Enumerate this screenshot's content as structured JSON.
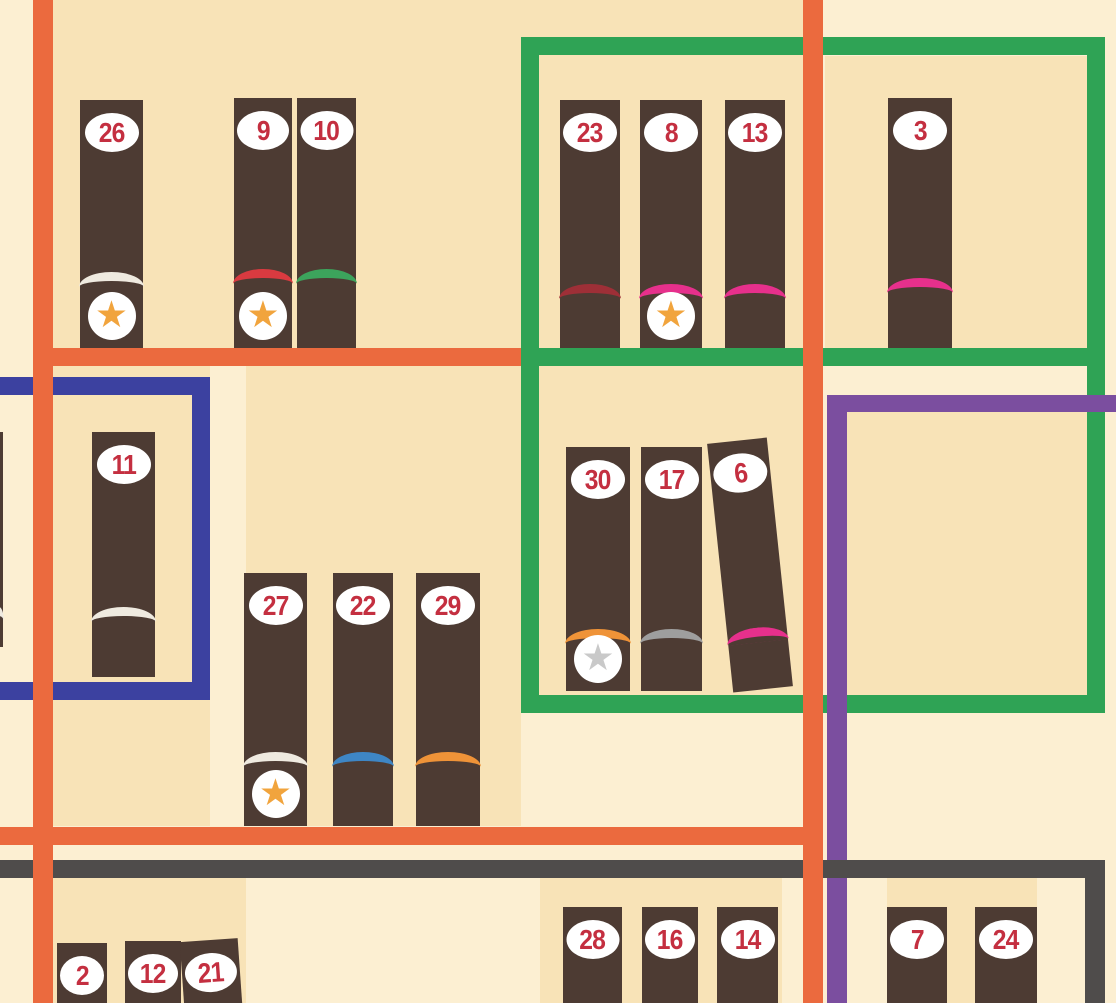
{
  "scene": {
    "description": "Bookshelf scene with numbered book spines, star badges and colored shelf frames",
    "visible_book_numbers": [
      26,
      9,
      10,
      23,
      8,
      13,
      3,
      11,
      30,
      17,
      6,
      27,
      22,
      29,
      2,
      12,
      21,
      28,
      16,
      14,
      7,
      24
    ]
  },
  "palette": {
    "bg_light": "#FCEFD2",
    "bg_shade": "#F8E3B7",
    "orange_frame": "#EB6A3E",
    "green_frame": "#2FA355",
    "blue_frame": "#3C41A0",
    "purple_frame": "#7B4E9F",
    "gray_frame": "#4F4C4B",
    "book_brown": "#4D3B33",
    "badge_white": "#FFFFFF",
    "number_red": "#C42F40",
    "star_orange": "#F1A43D",
    "star_silver": "#C9C9C9"
  },
  "stripe_colors": {
    "white": "#EFEAE0",
    "red": "#D93A40",
    "green": "#3CA45C",
    "maroon": "#9E2F37",
    "magenta": "#E6308C",
    "blue": "#3E86C5",
    "orange": "#EF9338",
    "gray": "#9E9E9E"
  },
  "star_glyph": "★",
  "panels": [
    {
      "x": 53,
      "y": 0,
      "w": 752,
      "h": 348
    },
    {
      "x": 825,
      "y": 56,
      "w": 262,
      "h": 292
    },
    {
      "x": 53,
      "y": 366,
      "w": 157,
      "h": 460
    },
    {
      "x": 246,
      "y": 366,
      "w": 275,
      "h": 460
    },
    {
      "x": 521,
      "y": 366,
      "w": 284,
      "h": 347
    },
    {
      "x": 847,
      "y": 412,
      "w": 240,
      "h": 283
    },
    {
      "x": 53,
      "y": 878,
      "w": 193,
      "h": 125
    },
    {
      "x": 540,
      "y": 878,
      "w": 242,
      "h": 125
    },
    {
      "x": 887,
      "y": 878,
      "w": 150,
      "h": 125
    }
  ],
  "frames": [
    {
      "name": "green-frame",
      "color": "green_frame",
      "bars": [
        {
          "part": "top-bar",
          "x": 521,
          "y": 37,
          "w": 584,
          "h": 18
        },
        {
          "part": "middle-bar",
          "x": 521,
          "y": 348,
          "w": 584,
          "h": 18
        },
        {
          "part": "bottom-bar",
          "x": 521,
          "y": 695,
          "w": 584,
          "h": 18
        },
        {
          "part": "left-bar",
          "x": 521,
          "y": 37,
          "w": 18,
          "h": 676
        },
        {
          "part": "right-bar",
          "x": 1087,
          "y": 37,
          "w": 18,
          "h": 676
        }
      ]
    },
    {
      "name": "blue-frame",
      "color": "blue_frame",
      "bars": [
        {
          "part": "top-bar",
          "x": -20,
          "y": 377,
          "w": 230,
          "h": 18
        },
        {
          "part": "bottom-bar",
          "x": -20,
          "y": 682,
          "w": 230,
          "h": 18
        },
        {
          "part": "right-bar",
          "x": 192,
          "y": 377,
          "w": 18,
          "h": 323
        }
      ]
    },
    {
      "name": "purple-frame",
      "color": "purple_frame",
      "bars": [
        {
          "part": "top-bar",
          "x": 827,
          "y": 395,
          "w": 289,
          "h": 17
        },
        {
          "part": "left-bar",
          "x": 827,
          "y": 395,
          "w": 20,
          "h": 608
        }
      ]
    },
    {
      "name": "gray-frame",
      "color": "gray_frame",
      "bars": [
        {
          "part": "shelf-bar",
          "x": 0,
          "y": 860,
          "w": 1105,
          "h": 18
        },
        {
          "part": "right-bar",
          "x": 1085,
          "y": 860,
          "w": 20,
          "h": 143
        }
      ]
    },
    {
      "name": "orange-frame",
      "color": "orange_frame",
      "bars": [
        {
          "part": "left-bar",
          "x": 33,
          "y": 0,
          "w": 20,
          "h": 1003
        },
        {
          "part": "right-bar",
          "x": 803,
          "y": 0,
          "w": 20,
          "h": 1003
        },
        {
          "part": "shelf-bar-top",
          "x": 33,
          "y": 348,
          "w": 488,
          "h": 18
        },
        {
          "part": "shelf-bar-bottom",
          "x": 0,
          "y": 827,
          "w": 823,
          "h": 18
        }
      ]
    }
  ],
  "books": [
    {
      "number": 26,
      "x": 80,
      "w": 63,
      "top": 100,
      "h": 248,
      "stripe": "white",
      "stripe_off": 76,
      "star": "orange",
      "tilt": 0
    },
    {
      "number": 9,
      "x": 234,
      "w": 58,
      "top": 98,
      "h": 250,
      "stripe": "red",
      "stripe_off": 79,
      "star": "orange",
      "tilt": 0
    },
    {
      "number": 10,
      "x": 297,
      "w": 59,
      "top": 98,
      "h": 250,
      "stripe": "green",
      "stripe_off": 79,
      "star": null,
      "tilt": 0
    },
    {
      "number": 23,
      "x": 560,
      "w": 60,
      "top": 100,
      "h": 248,
      "stripe": "maroon",
      "stripe_off": 64,
      "star": null,
      "tilt": 0
    },
    {
      "number": 8,
      "x": 640,
      "w": 62,
      "top": 100,
      "h": 248,
      "stripe": "magenta",
      "stripe_off": 64,
      "star": "orange",
      "tilt": 0
    },
    {
      "number": 13,
      "x": 725,
      "w": 60,
      "top": 100,
      "h": 248,
      "stripe": "magenta",
      "stripe_off": 64,
      "star": null,
      "tilt": 0
    },
    {
      "number": 3,
      "x": 888,
      "w": 64,
      "top": 98,
      "h": 250,
      "stripe": "magenta",
      "stripe_off": 70,
      "star": null,
      "tilt": 0
    },
    {
      "number": 11,
      "x": 92,
      "w": 63,
      "top": 432,
      "h": 245,
      "stripe": "white",
      "stripe_off": 70,
      "star": null,
      "tilt": 0
    },
    {
      "number": null,
      "x": -5,
      "w": 8,
      "top": 432,
      "h": 215,
      "stripe": "white",
      "stripe_off": 40,
      "star": null,
      "tilt": 0
    },
    {
      "number": 30,
      "x": 566,
      "w": 64,
      "top": 447,
      "h": 244,
      "stripe": "orange",
      "stripe_off": 62,
      "star": "silver",
      "tilt": 0
    },
    {
      "number": 17,
      "x": 641,
      "w": 61,
      "top": 447,
      "h": 244,
      "stripe": "gray",
      "stripe_off": 62,
      "star": null,
      "tilt": 0
    },
    {
      "number": 6,
      "x": 720,
      "w": 60,
      "top": 440,
      "h": 250,
      "stripe": "magenta",
      "stripe_off": 62,
      "star": null,
      "tilt": -6
    },
    {
      "number": 27,
      "x": 244,
      "w": 63,
      "top": 573,
      "h": 253,
      "stripe": "white",
      "stripe_off": 74,
      "star": "orange",
      "tilt": 0
    },
    {
      "number": 22,
      "x": 333,
      "w": 60,
      "top": 573,
      "h": 253,
      "stripe": "blue",
      "stripe_off": 74,
      "star": null,
      "tilt": 0
    },
    {
      "number": 29,
      "x": 416,
      "w": 64,
      "top": 573,
      "h": 253,
      "stripe": "orange",
      "stripe_off": 74,
      "star": null,
      "tilt": 0
    },
    {
      "number": 2,
      "x": 57,
      "w": 50,
      "top": 943,
      "h": 90,
      "stripe": null,
      "stripe_off": 0,
      "star": null,
      "tilt": 0
    },
    {
      "number": 12,
      "x": 125,
      "w": 56,
      "top": 941,
      "h": 92,
      "stripe": null,
      "stripe_off": 0,
      "star": null,
      "tilt": 0
    },
    {
      "number": 21,
      "x": 183,
      "w": 58,
      "top": 940,
      "h": 95,
      "stripe": null,
      "stripe_off": 0,
      "star": null,
      "tilt": -4
    },
    {
      "number": 28,
      "x": 563,
      "w": 59,
      "top": 907,
      "h": 110,
      "stripe": null,
      "stripe_off": 0,
      "star": null,
      "tilt": 0
    },
    {
      "number": 16,
      "x": 642,
      "w": 56,
      "top": 907,
      "h": 110,
      "stripe": null,
      "stripe_off": 0,
      "star": null,
      "tilt": 0
    },
    {
      "number": 14,
      "x": 717,
      "w": 61,
      "top": 907,
      "h": 110,
      "stripe": null,
      "stripe_off": 0,
      "star": null,
      "tilt": 0
    },
    {
      "number": 7,
      "x": 887,
      "w": 60,
      "top": 907,
      "h": 110,
      "stripe": null,
      "stripe_off": 0,
      "star": null,
      "tilt": 0
    },
    {
      "number": 24,
      "x": 975,
      "w": 62,
      "top": 907,
      "h": 110,
      "stripe": null,
      "stripe_off": 0,
      "star": null,
      "tilt": 0
    }
  ]
}
